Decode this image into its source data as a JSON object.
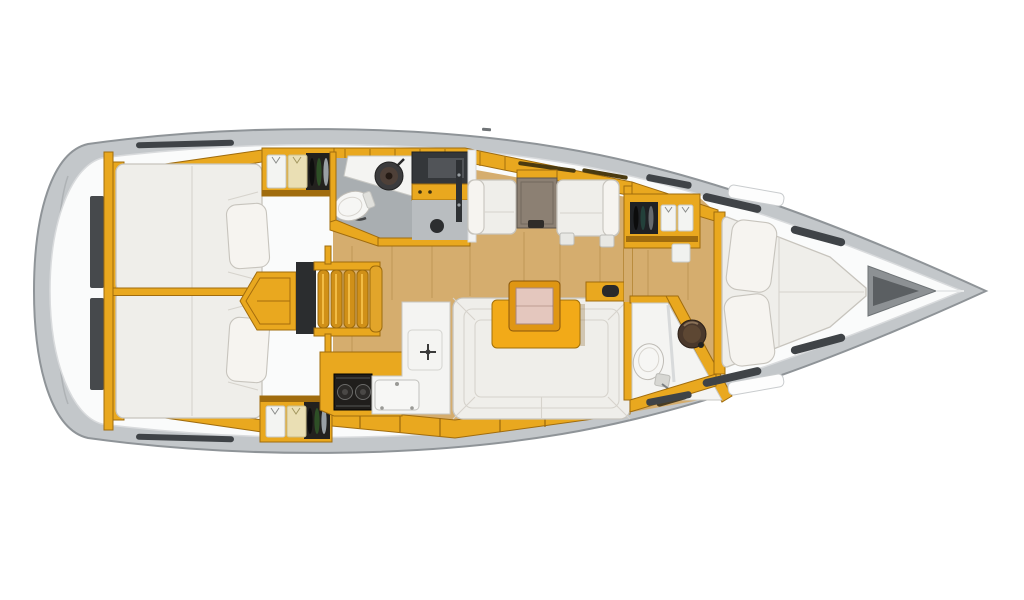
{
  "diagram": {
    "type": "floor-plan",
    "subject": "sailing-yacht interior layout, top-down view",
    "bow_direction": "right",
    "cabins_visible": 3,
    "heads_visible": 2
  },
  "regions": {
    "hull": "Hull",
    "deck": "Side deck",
    "transom": "Transom stowage",
    "aft_cabin_port": "Aft double cabin (port)",
    "aft_cabin_starboard": "Aft double cabin (starboard)",
    "wardrobe_aft_port": "Hanging locker with clothes (port)",
    "wardrobe_aft_starboard": "Hanging locker with clothes (starboard)",
    "aft_head": "Aft head with washbasin and toilet",
    "shower_console": "Aft shower compartment",
    "companionway": "Companionway steps and engine box",
    "galley": "L-shaped galley with stove, sink and icebox",
    "chart_seating": "Facing settees with table",
    "saloon": "Saloon U-shaped sofa",
    "saloon_table": "Saloon table with folding leaf",
    "head_door_cabinet": "Forward head door cabinet",
    "fwd_head": "Forward head with toilet and washbasin",
    "fwd_wardrobe": "Forward cabin wardrobe",
    "forward_cabin": "Forward cabin V-berth",
    "anchor_locker": "Anchor locker",
    "mast_mark": "Mast position mark"
  },
  "palette": {
    "hull": "#c3c7ca",
    "hull_outline": "#8f9498",
    "deck": "#fafbfb",
    "deck_line": "#d9dbdd",
    "floor_wood": "#d5ad6e",
    "furniture_wood": "#e9a81f",
    "furniture_wood_dark": "#a06c0e",
    "upholstery": "#efeeea",
    "upholstery_outline": "#c7c4bd",
    "dark_fixture": "#34373a",
    "head_floor": "#a9aeb1",
    "table_yellow": "#f2aa18",
    "table_leaf_pink": "#e4c7be",
    "stove_black": "#201e1c",
    "sink_dark": "#3b3b3d"
  }
}
